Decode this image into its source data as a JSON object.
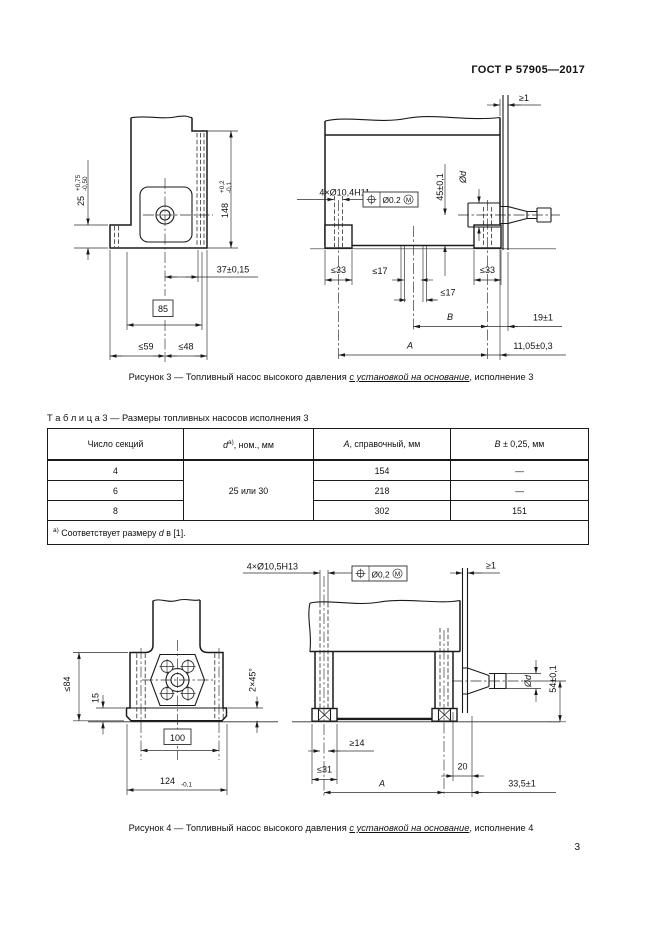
{
  "page": {
    "standard": "ГОСТ Р 57905—2017",
    "page_number": "3"
  },
  "fig3": {
    "caption_prefix": "Рисунок 3 — Топливный насос высокого давления ",
    "caption_underline": "с установкой на основание",
    "caption_suffix": ", исполнение 3",
    "dims": {
      "d25": "25",
      "d25_tol_up": "+0,75",
      "d25_tol_dn": "-0,50",
      "d148": "148",
      "d148_tol_up": "+0,2",
      "d148_tol_dn": "-0,1",
      "d37": "37±0,15",
      "d85": "85",
      "d59": "≤59",
      "d48": "≤48",
      "holes": "4×Ø10,4H11",
      "tol_value": "Ø0.2",
      "tol_mod": "M",
      "ge1": "≥1",
      "d45": "45±0,1",
      "dia": "Ød",
      "le33": "≤33",
      "le17": "≤17",
      "dB": "B",
      "d19": "19±1",
      "dA": "A",
      "d1105": "11,05±0,3"
    }
  },
  "table3": {
    "label": "Т а б л и ц а  3",
    "title": " — Размеры топливных насосов исполнения 3",
    "col1": "Число секций",
    "col2_d": "d",
    "col2_sup": "а)",
    "col2_rest": ", ном., мм",
    "col3_A": "А",
    "col3_rest": ", справочный, мм",
    "col4_B": "В",
    "col4_rest": " ± 0,25, мм",
    "merged_d": "25 или 30",
    "rows": [
      {
        "n": "4",
        "a": "154",
        "b": "—"
      },
      {
        "n": "6",
        "a": "218",
        "b": "—"
      },
      {
        "n": "8",
        "a": "302",
        "b": "151"
      }
    ],
    "foot_sup": "а)",
    "foot_text1": " Соответствует размеру ",
    "foot_d": "d",
    "foot_text2": " в [1]."
  },
  "fig4": {
    "caption_prefix": "Рисунок 4 — Топливный насос высокого давления ",
    "caption_underline": "с установкой на основание",
    "caption_suffix": ", исполнение 4",
    "dims": {
      "holes": "4×Ø10,5H13",
      "tol_value": "Ø0,2",
      "tol_mod": "M",
      "ge1": "≥1",
      "le84": "≤84",
      "d15": "15",
      "d100": "100",
      "d124": "124",
      "d124_tol": "-0,1",
      "chamfer": "2×45°",
      "ge14": "≥14",
      "le31": "≤31",
      "d20": "20",
      "dA": "A",
      "d335": "33,5±1",
      "dia": "Ød",
      "d54": "54±0,1"
    }
  }
}
